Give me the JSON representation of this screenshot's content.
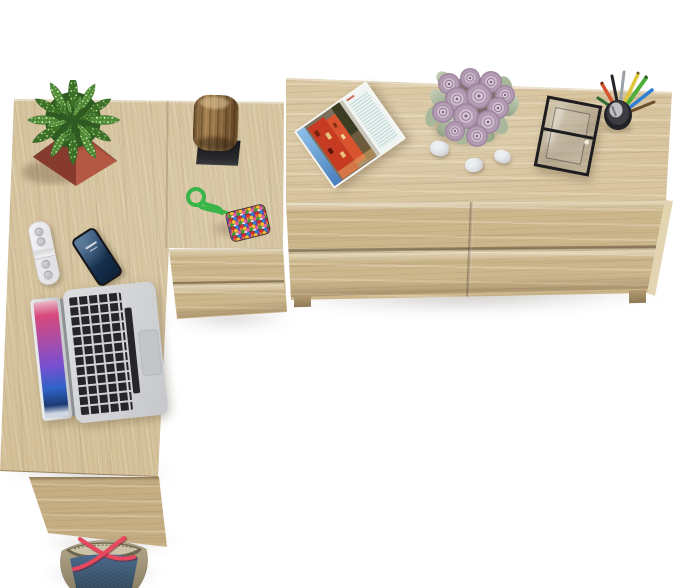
{
  "scene": {
    "type": "product-photo",
    "description": "Top-down view of a light sonoma-oak home-office set on a white floor: an L-shaped desk with a corner drawer unit on the left and a long two-by-two drawer sideboard on the right. Styled with a cactus in a terracotta pot, a wooden log ornament, a bead keychain, a white remote, a smartphone, an open silver laptop, an open magazine, a bouquet of lilac roses with three white pebbles, a glass display box, a cup of pens and pencils, and a navy tote bag with red straps.",
    "background": "#ffffff",
    "furniture": [
      {
        "name": "sideboard",
        "label": "oak sideboard with four drawers",
        "material": "sonoma oak"
      },
      {
        "name": "desk",
        "label": "L-shaped oak desk",
        "material": "sonoma oak"
      },
      {
        "name": "corner-drawer-unit",
        "label": "oak corner drawer unit",
        "material": "sonoma oak"
      },
      {
        "name": "desk-side-panel",
        "label": "desk side support panel",
        "material": "sonoma oak"
      }
    ],
    "items": [
      {
        "name": "cactus-plant",
        "label": "speckled succulent in terracotta pot",
        "box": {
          "left": 14,
          "top": 80,
          "width": 112,
          "height": 112,
          "rotate": 0
        }
      },
      {
        "name": "wood-stump",
        "label": "log ornament on black base",
        "box": {
          "left": 190,
          "top": 94,
          "width": 56,
          "height": 74,
          "rotate": 2
        }
      },
      {
        "name": "bead-keychain",
        "label": "multicolour bead pouch keychain",
        "box": {
          "left": 178,
          "top": 183,
          "width": 100,
          "height": 66,
          "rotate": 0
        }
      },
      {
        "name": "white-remote",
        "label": "white remote control",
        "box": {
          "left": 33,
          "top": 221,
          "width": 20,
          "height": 62,
          "rotate": -12
        }
      },
      {
        "name": "smartphone",
        "label": "black smartphone",
        "box": {
          "left": 83,
          "top": 229,
          "width": 28,
          "height": 56,
          "rotate": -33
        }
      },
      {
        "name": "laptop",
        "label": "open silver laptop",
        "box": {
          "left": 34,
          "top": 285,
          "width": 130,
          "height": 138,
          "rotate": -6
        }
      },
      {
        "name": "magazine",
        "label": "open magazine with red building photo",
        "box": {
          "left": 306,
          "top": 100,
          "width": 88,
          "height": 70,
          "rotate": -35
        }
      },
      {
        "name": "rose-bouquet",
        "label": "bouquet of dusty lilac roses",
        "box": {
          "left": 425,
          "top": 60,
          "width": 100,
          "height": 118,
          "rotate": 0
        }
      },
      {
        "name": "pebble-1",
        "label": "white pebble",
        "box": {
          "left": 430,
          "top": 141,
          "width": 19,
          "height": 15,
          "rotate": 12
        }
      },
      {
        "name": "pebble-2",
        "label": "white pebble",
        "box": {
          "left": 465,
          "top": 158,
          "width": 18,
          "height": 14,
          "rotate": -6
        }
      },
      {
        "name": "pebble-3",
        "label": "white pebble",
        "box": {
          "left": 494,
          "top": 150,
          "width": 17,
          "height": 13,
          "rotate": 18
        }
      },
      {
        "name": "glass-display-box",
        "label": "black framed glass display box",
        "box": {
          "left": 540,
          "top": 100,
          "width": 50,
          "height": 66,
          "rotate": 11
        }
      },
      {
        "name": "pencil-cup",
        "label": "cup with pens and pencils",
        "box": {
          "left": 590,
          "top": 68,
          "width": 72,
          "height": 68,
          "rotate": 0
        }
      },
      {
        "name": "tote-bag",
        "label": "navy tote bag with red straps",
        "box": {
          "left": 50,
          "top": 527,
          "width": 106,
          "height": 61,
          "rotate": 0
        }
      }
    ]
  },
  "palette": {
    "floor_white": "#ffffff",
    "wood_top": "#d8c59f",
    "wood_front": "#ccb78d",
    "wood_desk": "#d3c098",
    "wood_panel": "#c5ae83",
    "pot_terracotta": "#a84b3b",
    "plant_green": "#4e8a33",
    "cord_green": "#39b54a",
    "bead_base": "#5a3f4e",
    "rose_lilac": "#c9b6c8",
    "leaf_sage": "#a9b89b",
    "stone_white": "#eceff1",
    "glass_frame": "#1d1d1f",
    "pencil_cup": "#222226",
    "magazine_red": "#c63b22",
    "magazine_sky": "#6aa6d8",
    "laptop_silver": "#d2d4d6",
    "key_black": "#26262a",
    "screen_pink": "#d8497c",
    "screen_purple": "#7a4fd0",
    "screen_blue": "#2f63c8",
    "phone_black": "#16161a",
    "remote_white": "#f4f4f6",
    "denim_navy": "#3f5c77",
    "bag_khaki": "#aa9e82",
    "strap_red": "#e8485e"
  }
}
